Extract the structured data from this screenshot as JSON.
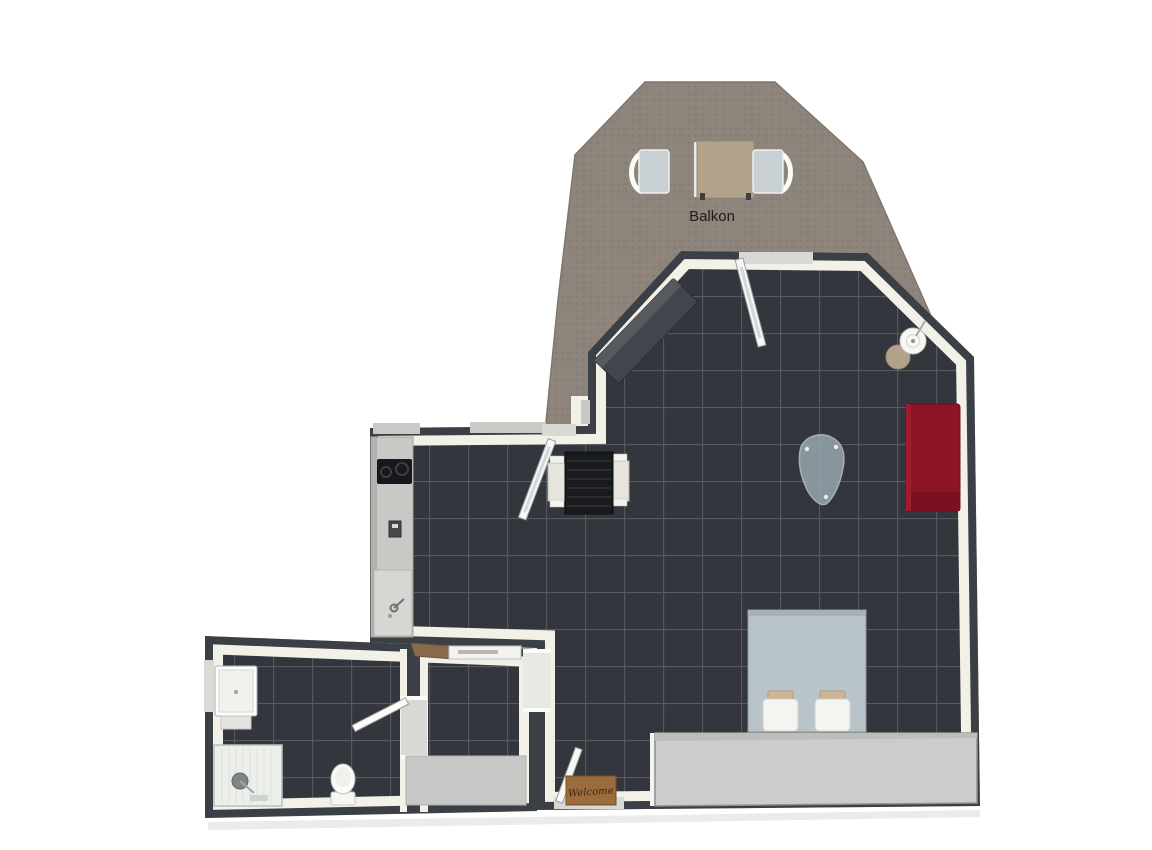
{
  "labels": {
    "balcony": "Balkon",
    "welcome_mat": "Welcome"
  },
  "colors": {
    "page_bg": "#ffffff",
    "wall_dark": "#3b3f46",
    "wall_inner": "#f2f1e8",
    "tile_floor": "#33363c",
    "tile_line": "#6a6e75",
    "balcony_floor": "#8d847b",
    "balcony_speckle": "#7d746c",
    "sofa_red": "#8e1526",
    "bed_blue": "#b9c3ca",
    "pillow_white": "#f4f4f1",
    "cushion_tan": "#cdb593",
    "closet_gray": "#cccccb",
    "counter_gray": "#c8c8c4",
    "glass_table": "#97a6af",
    "mat_brown": "#9b6c3e",
    "wood_brown": "#8a6a4e",
    "dark_sofa": "#42464c",
    "chair_cream": "#e6e4dc",
    "table_black": "#191a1d",
    "lamp_shade": "#f7f7f4",
    "side_table_tan": "#b3a28a",
    "rug_gray": "#c7c7c5",
    "threshold_light": "#d8d8d4",
    "window_gray": "#c9c9c6"
  },
  "furniture": [
    "balcony-table",
    "balcony-chair-left",
    "balcony-chair-right",
    "dark-sofa",
    "balcony-door",
    "floor-lamp",
    "side-table",
    "red-sofa",
    "glass-coffee-table",
    "dining-table",
    "dining-chair-left",
    "dining-chair-right",
    "kitchen-counter",
    "cooktop",
    "kitchen-sink",
    "kitchen-balcony-door",
    "bed",
    "pillows",
    "closet",
    "entry-door",
    "welcome-mat",
    "coat-shelf",
    "hall-rug",
    "bathroom-door",
    "washbasin",
    "shower",
    "toilet"
  ]
}
